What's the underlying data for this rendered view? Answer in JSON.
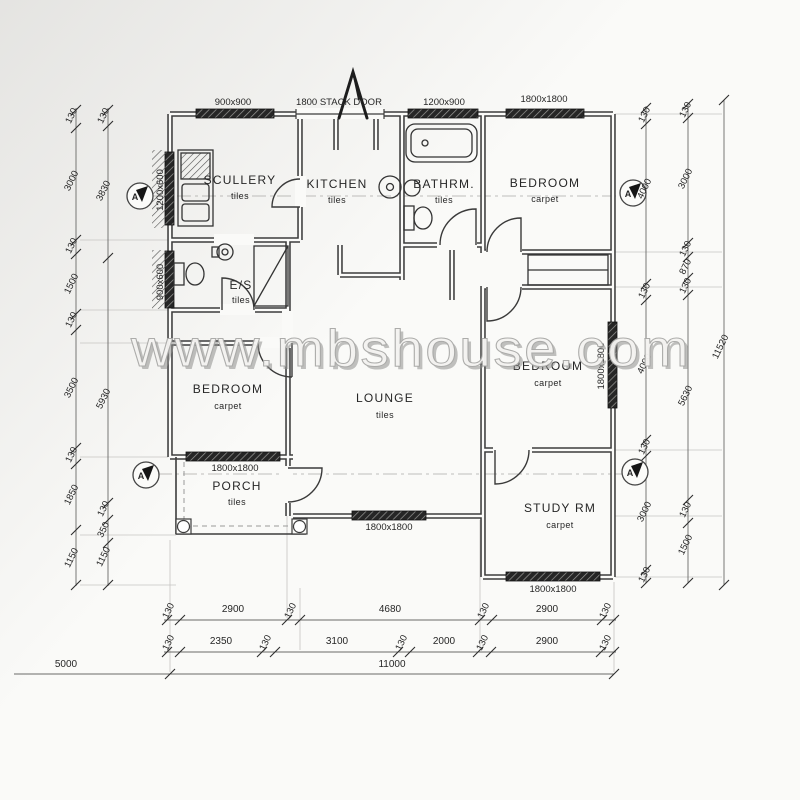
{
  "watermark": "www.mbshouse.com",
  "section_label": "A",
  "rooms": {
    "scullery": {
      "name": "SCULLERY",
      "finish": "tiles"
    },
    "kitchen": {
      "name": "KITCHEN",
      "finish": "tiles"
    },
    "bathroom": {
      "name": "BATHRM.",
      "finish": "tiles"
    },
    "bedroom_top": {
      "name": "BEDROOM",
      "finish": "carpet"
    },
    "ensuite": {
      "name": "E/S",
      "finish": "tiles"
    },
    "bedroom_left": {
      "name": "BEDROOM",
      "finish": "carpet"
    },
    "lounge": {
      "name": "LOUNGE",
      "finish": "tiles"
    },
    "bedroom_right": {
      "name": "BEDROOM",
      "finish": "carpet"
    },
    "porch": {
      "name": "PORCH",
      "finish": "tiles"
    },
    "study": {
      "name": "STUDY RM",
      "finish": "carpet"
    }
  },
  "openings": {
    "top_scullery_window": "900x900",
    "stack_door": "1800 STACK DOOR",
    "top_bathroom_window": "1200x900",
    "top_bedroom_window": "1800x1800",
    "left_scullery_window": "1200x600",
    "left_ensuite_window": "900x600",
    "right_bedroom_window": "1800x1800",
    "porch_window": "1800x1800",
    "lounge_window": "1800x1800",
    "study_window": "1800x1800"
  },
  "dimensions": {
    "left_outer": [
      "130",
      "3000",
      "130",
      "1500",
      "130",
      "3500",
      "130",
      "1850",
      "1150"
    ],
    "left_inner": [
      "130",
      "3830",
      "5930",
      "130",
      "350",
      "1150"
    ],
    "right_inner": [
      "130",
      "4000",
      "130",
      "4000",
      "130",
      "3000",
      "130"
    ],
    "right_middle": [
      "130",
      "3000",
      "130",
      "870",
      "130",
      "5630",
      "130",
      "1500"
    ],
    "right_total": "11520",
    "bottom_upper": [
      "130",
      "2900",
      "130",
      "4680",
      "130",
      "2900",
      "130"
    ],
    "bottom_lower": [
      "130",
      "2350",
      "130",
      "3100",
      "130",
      "2000",
      "130",
      "2900",
      "130"
    ],
    "bottom_total": "11000",
    "bottom_left_ext": "5000"
  }
}
